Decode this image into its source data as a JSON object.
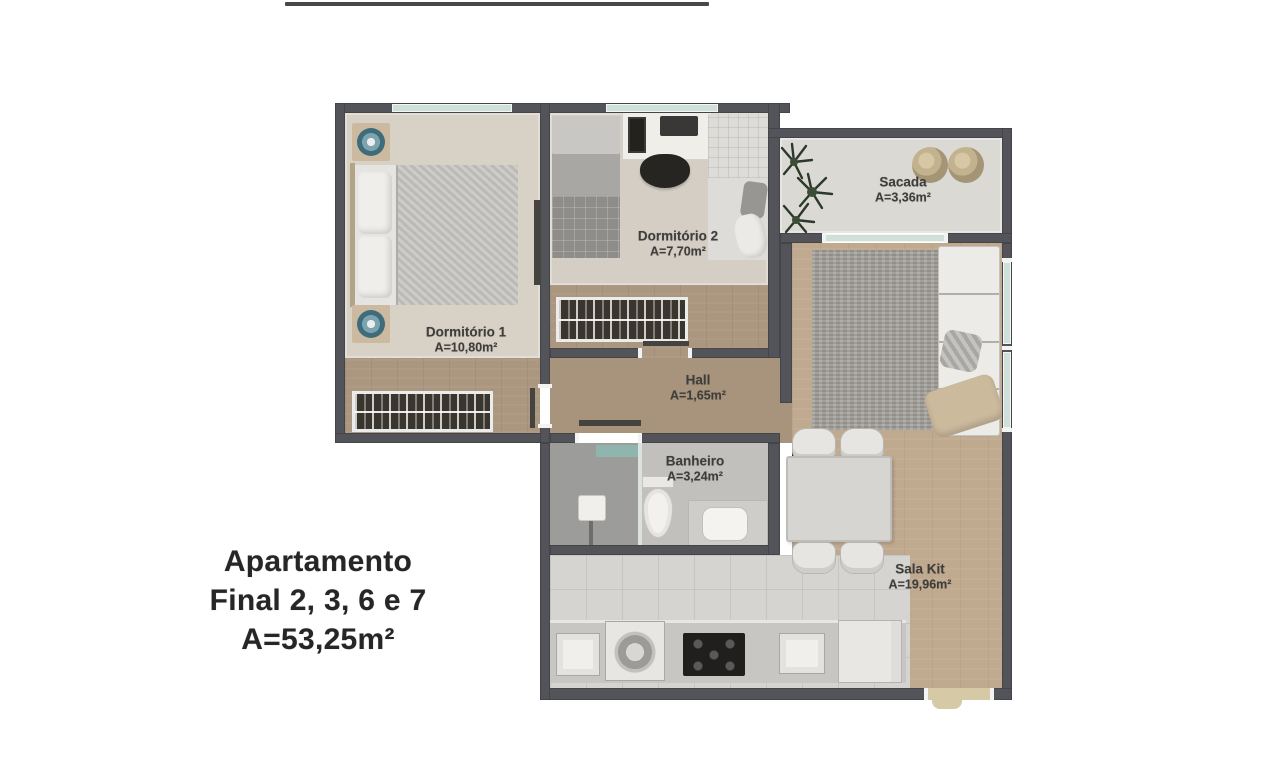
{
  "title": {
    "line1": "Apartamento",
    "line2": "Final 2, 3, 6 e 7",
    "line3": "A=53,25m²"
  },
  "rooms": {
    "dormitorio1": {
      "name": "Dormitório 1",
      "area": "A=10,80m²"
    },
    "dormitorio2": {
      "name": "Dormitório 2",
      "area": "A=7,70m²"
    },
    "sacada": {
      "name": "Sacada",
      "area": "A=3,36m²"
    },
    "hall": {
      "name": "Hall",
      "area": "A=1,65m²"
    },
    "banheiro": {
      "name": "Banheiro",
      "area": "A=3,24m²"
    },
    "sala_kit": {
      "name": "Sala Kit",
      "area": "A=19,96m²"
    }
  },
  "colors": {
    "wall": "#53545a",
    "window_glass": "#cfe0da",
    "wood_dark": "#ab9680",
    "wood_light": "#c0aa8f",
    "carpet": "#d8d1c5",
    "tile": "#d6d4d0",
    "entry_door": "#d6c9a6",
    "label_text": "#3e3d3b",
    "title_text": "#262626",
    "accent_teal": "#8fb5ae"
  }
}
